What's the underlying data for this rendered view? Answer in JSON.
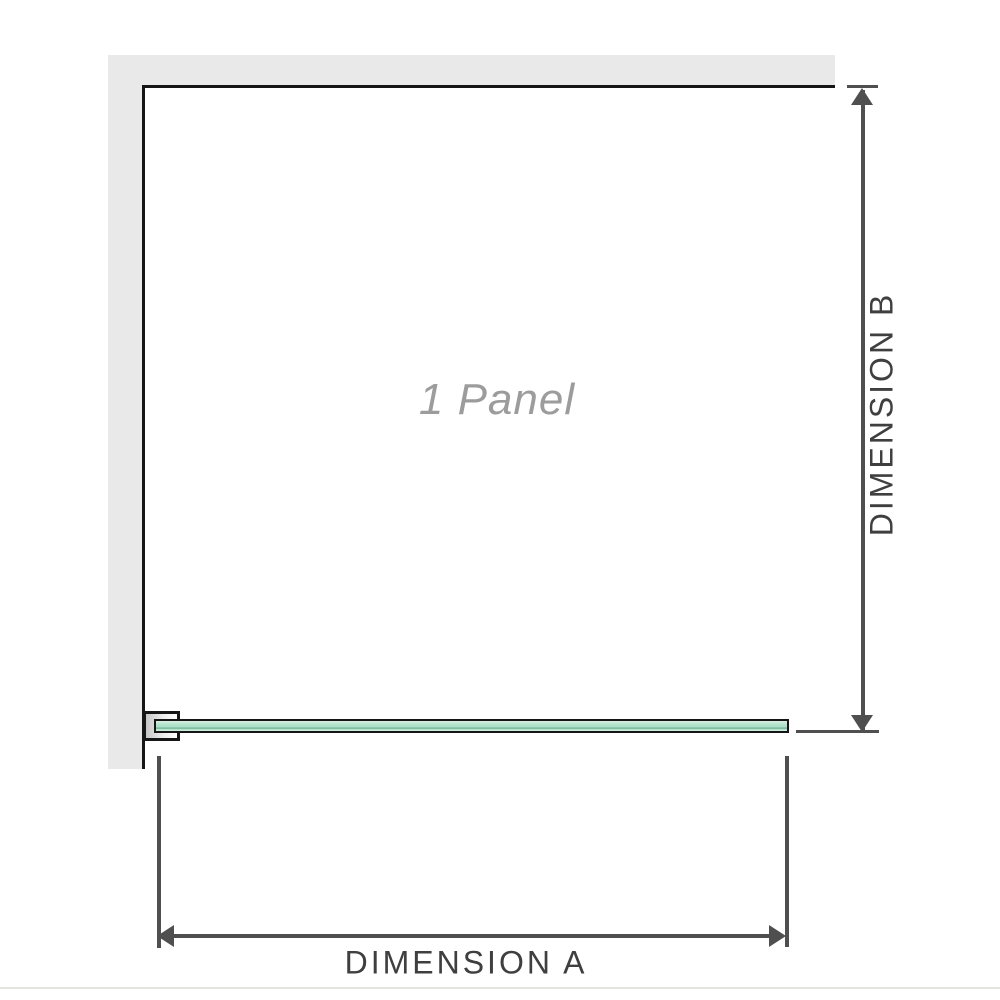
{
  "diagram": {
    "panel_label": "1 Panel",
    "dimensions": {
      "a": {
        "label": "DIMENSION A",
        "orientation": "horizontal"
      },
      "b": {
        "label": "DIMENSION B",
        "orientation": "vertical"
      }
    },
    "parts": {
      "wall": "l-shaped-wall",
      "bracket": "wall-to-glass-bracket",
      "glass": "glass-panel-plan-view"
    }
  },
  "colors": {
    "wall_fill": "#e9e9e9",
    "outline": "#161616",
    "dim_color": "#4f4f4f",
    "label_color": "#3f3f3f",
    "panel_label_color": "#9c9c9c",
    "glass_light": "#d8f0e2",
    "glass_mid": "#aee2c8",
    "glass_dark": "#6fae91",
    "baseline_color": "#e5e5e0"
  }
}
